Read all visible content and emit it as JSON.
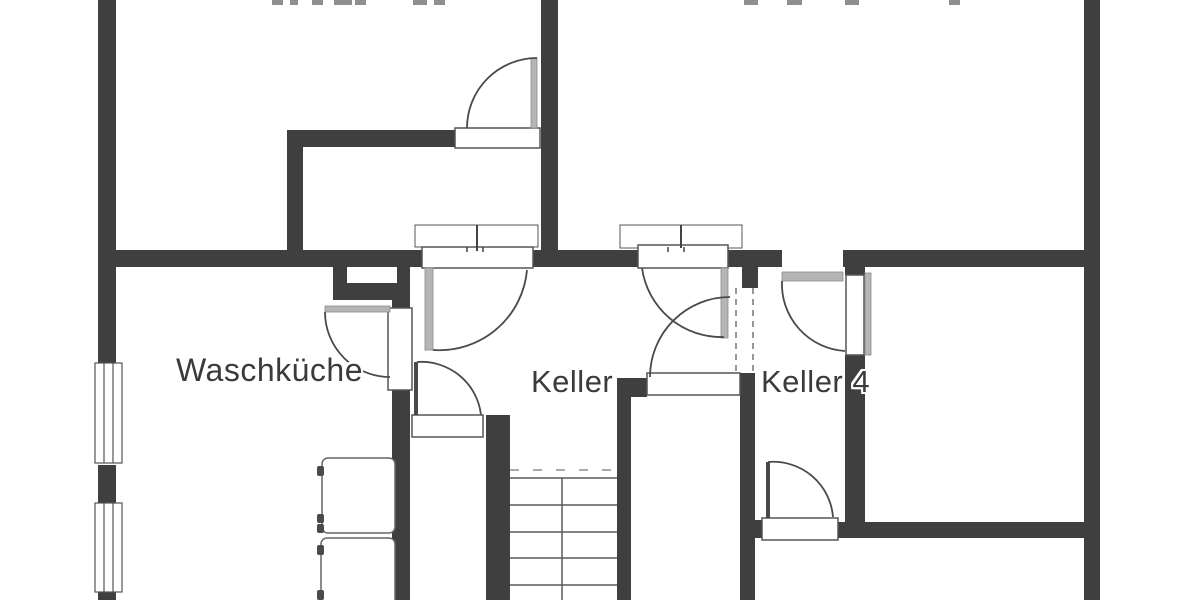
{
  "document_type": "basement-floor-plan",
  "colors": {
    "background": "#ffffff",
    "wall": "#3f3f3f",
    "thin_line": "#4a4a4a",
    "door_leaf_gray": "#b5b5b5",
    "threshold_stroke": "#555555",
    "stair_line": "#5a5a5a",
    "dashed_line": "#777777",
    "cut_line": "#aaaaaa",
    "fixture_stroke": "#666666",
    "top_tick": "#8f8f8f",
    "label_text": "#3b3b3b"
  },
  "rooms": [
    {
      "label": "Waschküche",
      "x": 176,
      "y": 354,
      "size": 32
    },
    {
      "label": "Keller",
      "x": 531,
      "y": 366,
      "size": 31
    },
    {
      "label": "Keller 4",
      "x": 761,
      "y": 366,
      "size": 31
    }
  ],
  "plan": {
    "walls": [
      {
        "x": 98,
        "y": 0,
        "w": 18,
        "h": 363
      },
      {
        "x": 98,
        "y": 465,
        "w": 18,
        "h": 38
      },
      {
        "x": 98,
        "y": 592,
        "w": 18,
        "h": 8
      },
      {
        "x": 541,
        "y": 0,
        "w": 17,
        "h": 267
      },
      {
        "x": 1084,
        "y": 0,
        "w": 16,
        "h": 600
      },
      {
        "x": 98,
        "y": 250,
        "w": 324,
        "h": 17
      },
      {
        "x": 533,
        "y": 250,
        "w": 105,
        "h": 17
      },
      {
        "x": 728,
        "y": 250,
        "w": 54,
        "h": 17
      },
      {
        "x": 843,
        "y": 250,
        "w": 241,
        "h": 17
      },
      {
        "x": 287,
        "y": 130,
        "w": 168,
        "h": 17
      },
      {
        "x": 287,
        "y": 130,
        "w": 16,
        "h": 137
      },
      {
        "x": 333,
        "y": 267,
        "w": 77,
        "h": 33
      },
      {
        "x": 392,
        "y": 297,
        "w": 18,
        "h": 11
      },
      {
        "x": 392,
        "y": 390,
        "w": 18,
        "h": 210
      },
      {
        "x": 486,
        "y": 415,
        "w": 24,
        "h": 185
      },
      {
        "x": 617,
        "y": 378,
        "w": 14,
        "h": 222
      },
      {
        "x": 617,
        "y": 378,
        "w": 30,
        "h": 19
      },
      {
        "x": 740,
        "y": 373,
        "w": 15,
        "h": 227
      },
      {
        "x": 742,
        "y": 267,
        "w": 16,
        "h": 21
      },
      {
        "x": 845,
        "y": 265,
        "w": 20,
        "h": 10
      },
      {
        "x": 845,
        "y": 355,
        "w": 20,
        "h": 183
      },
      {
        "x": 838,
        "y": 522,
        "w": 246,
        "h": 16
      },
      {
        "x": 755,
        "y": 520,
        "w": 7,
        "h": 18
      }
    ],
    "notches": [
      {
        "x": 347,
        "y": 267,
        "w": 50,
        "h": 16
      }
    ],
    "windows": [
      {
        "x": 95,
        "y": 363,
        "w": 27,
        "h": 100
      },
      {
        "x": 95,
        "y": 503,
        "w": 27,
        "h": 89
      }
    ],
    "thresholds": [
      {
        "x": 455,
        "y": 128,
        "w": 85,
        "h": 20,
        "sw": 1.5
      },
      {
        "x": 415,
        "y": 225,
        "w": 123,
        "h": 22,
        "sw": 1
      },
      {
        "x": 422,
        "y": 247,
        "w": 111,
        "h": 21,
        "sw": 1.5
      },
      {
        "x": 620,
        "y": 225,
        "w": 122,
        "h": 23,
        "sw": 1
      },
      {
        "x": 638,
        "y": 245,
        "w": 90,
        "h": 23,
        "sw": 1.5
      },
      {
        "x": 388,
        "y": 308,
        "w": 24,
        "h": 82,
        "sw": 1.5
      },
      {
        "x": 412,
        "y": 415,
        "w": 71,
        "h": 22,
        "sw": 1.5
      },
      {
        "x": 647,
        "y": 373,
        "w": 93,
        "h": 22,
        "sw": 1.5
      },
      {
        "x": 846,
        "y": 275,
        "w": 18,
        "h": 80,
        "sw": 1.5
      },
      {
        "x": 762,
        "y": 518,
        "w": 76,
        "h": 22,
        "sw": 1.5
      }
    ],
    "leaves": [
      {
        "x": 531,
        "y": 58,
        "w": 6,
        "h": 70
      },
      {
        "x": 325,
        "y": 306,
        "w": 65,
        "h": 6
      },
      {
        "x": 425,
        "y": 268,
        "w": 8,
        "h": 82
      },
      {
        "x": 721,
        "y": 268,
        "w": 7,
        "h": 70
      },
      {
        "x": 782,
        "y": 272,
        "w": 61,
        "h": 9
      },
      {
        "x": 865,
        "y": 273,
        "w": 6,
        "h": 82
      }
    ],
    "thin_leaves": [
      {
        "x": 414,
        "y": 362,
        "w": 4,
        "h": 53
      },
      {
        "x": 766,
        "y": 462,
        "w": 4,
        "h": 56
      }
    ],
    "arcs": [
      {
        "d": "M 467 128 A 70 70 0 0 1 537 58"
      },
      {
        "d": "M 325 312 A 65 65 0 0 0 390 377"
      },
      {
        "d": "M 417 362 A 60 60 0 0 1 481 415"
      },
      {
        "d": "M 433 350 A 88 88 0 0 0 527 270"
      },
      {
        "d": "M 642 268 A 80 80 0 0 0 724 337"
      },
      {
        "d": "M 650 377 A 80 80 0 0 1 730 297"
      },
      {
        "d": "M 782 281 A 67 67 0 0 0 845 351"
      },
      {
        "d": "M 768 462 A 60 60 0 0 1 833 517"
      }
    ],
    "dashed_lines": [
      {
        "x1": 736,
        "y1": 288,
        "x2": 736,
        "y2": 373,
        "dash": "6,5",
        "color": "#777777",
        "w": 1.5
      },
      {
        "x1": 753,
        "y1": 288,
        "x2": 753,
        "y2": 373,
        "dash": "6,5",
        "color": "#777777",
        "w": 1.5
      },
      {
        "x1": 510,
        "y1": 470,
        "x2": 613,
        "y2": 470,
        "dash": "9,14",
        "color": "#aaaaaa",
        "w": 2
      }
    ],
    "stairs": {
      "x1": 510,
      "x2": 617,
      "treads": [
        478,
        505,
        532,
        558,
        585
      ],
      "center_x": 562,
      "center_y1": 478,
      "center_y2": 600
    },
    "fixtures": [
      {
        "x": 322,
        "y": 458,
        "w": 73,
        "h": 75
      },
      {
        "x": 321,
        "y": 538,
        "w": 74,
        "h": 70
      }
    ],
    "fixture_nubs": [
      {
        "x": 317,
        "y": 466,
        "w": 7,
        "h": 10
      },
      {
        "x": 317,
        "y": 514,
        "w": 7,
        "h": 9
      },
      {
        "x": 317,
        "y": 524,
        "w": 7,
        "h": 9
      },
      {
        "x": 317,
        "y": 545,
        "w": 7,
        "h": 10
      },
      {
        "x": 317,
        "y": 590,
        "w": 7,
        "h": 10
      }
    ],
    "center_ticks": [
      {
        "x": 477,
        "y1": 225,
        "y2": 251
      },
      {
        "x": 681,
        "y1": 225,
        "y2": 248
      }
    ],
    "mini_ticks": [
      {
        "x": 467,
        "y1": 247,
        "y2": 252
      },
      {
        "x": 483,
        "y1": 247,
        "y2": 252
      },
      {
        "x": 668,
        "y1": 247,
        "y2": 252
      },
      {
        "x": 684,
        "y1": 247,
        "y2": 252
      }
    ],
    "top_ticks": [
      {
        "x": 272,
        "w": 11
      },
      {
        "x": 290,
        "w": 8
      },
      {
        "x": 312,
        "w": 11
      },
      {
        "x": 334,
        "w": 18
      },
      {
        "x": 355,
        "w": 11
      },
      {
        "x": 413,
        "w": 14
      },
      {
        "x": 434,
        "w": 11
      },
      {
        "x": 744,
        "w": 14
      },
      {
        "x": 787,
        "w": 15
      },
      {
        "x": 845,
        "w": 14
      },
      {
        "x": 949,
        "w": 11
      }
    ]
  }
}
